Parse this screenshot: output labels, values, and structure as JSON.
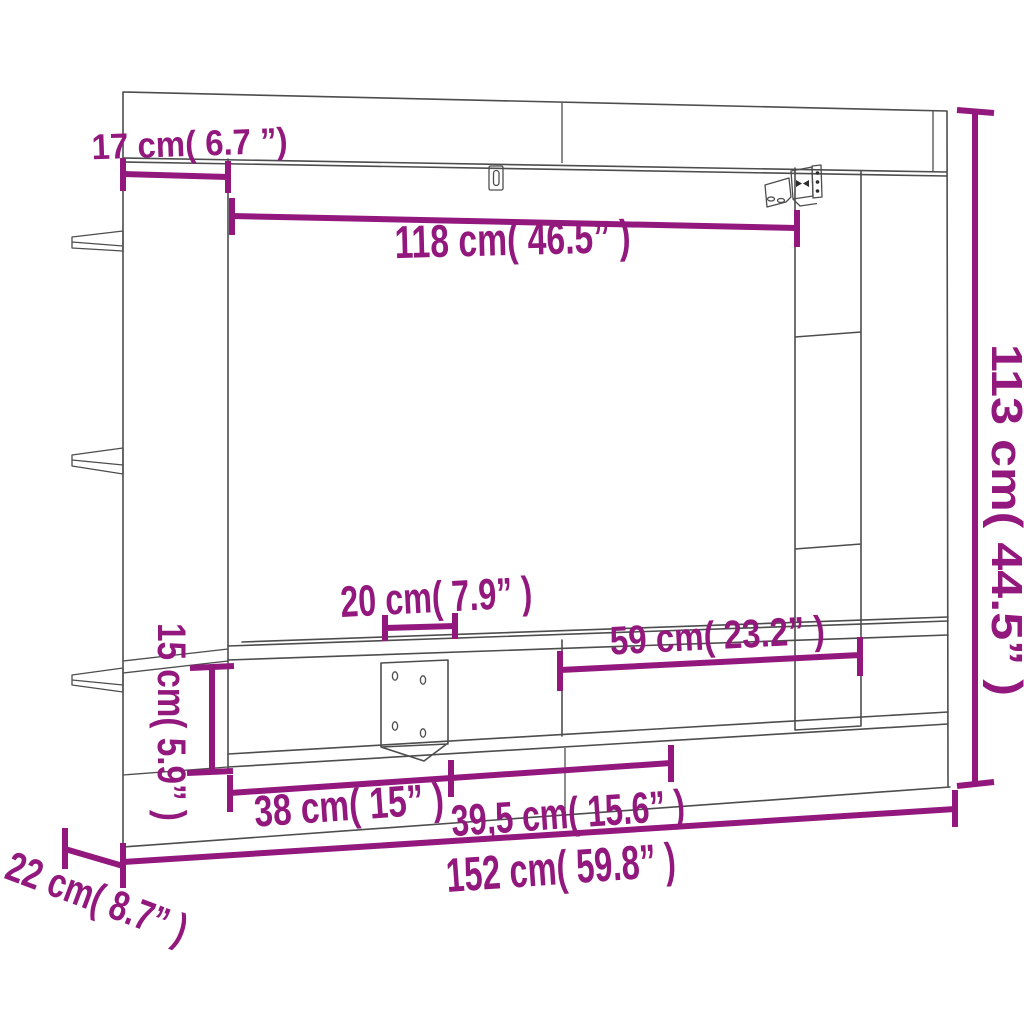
{
  "meta": {
    "description": "Dimension diagram of a wall-mounted TV cabinet with side shelves"
  },
  "colors": {
    "dimension": "#93187D",
    "drawing_outline": "#4D4D4D",
    "background": "#FFFFFF"
  },
  "dimensions": {
    "shelf_depth": {
      "value_cm": "17",
      "value_in": "6.7",
      "label": "17 cm( 6.7 ”)"
    },
    "inner_width": {
      "value_cm": "118",
      "value_in": "46.5",
      "label": "118 cm( 46.5” )"
    },
    "total_height": {
      "value_cm": "113",
      "value_in": "44.5",
      "label": "113 cm( 44.5” )"
    },
    "center_niche_width": {
      "value_cm": "20",
      "value_in": "7.9",
      "label": "20 cm( 7.9” )"
    },
    "right_niche_width": {
      "value_cm": "59",
      "value_in": "23.2",
      "label": "59 cm( 23.2” )"
    },
    "compartment_height": {
      "value_cm": "15",
      "value_in": "5.9",
      "label": "15 cm( 5.9” )"
    },
    "left_compartment_width": {
      "value_cm": "38",
      "value_in": "15",
      "label": "38 cm( 15” )"
    },
    "mid_compartment_width": {
      "value_cm": "39,5",
      "value_in": "15.6",
      "label": "39,5 cm( 15.6” )"
    },
    "total_width": {
      "value_cm": "152",
      "value_in": "59.8",
      "label": "152 cm( 59.8” )"
    },
    "depth": {
      "value_cm": "22",
      "value_in": "8.7",
      "label": "22 cm( 8.7” )"
    }
  }
}
